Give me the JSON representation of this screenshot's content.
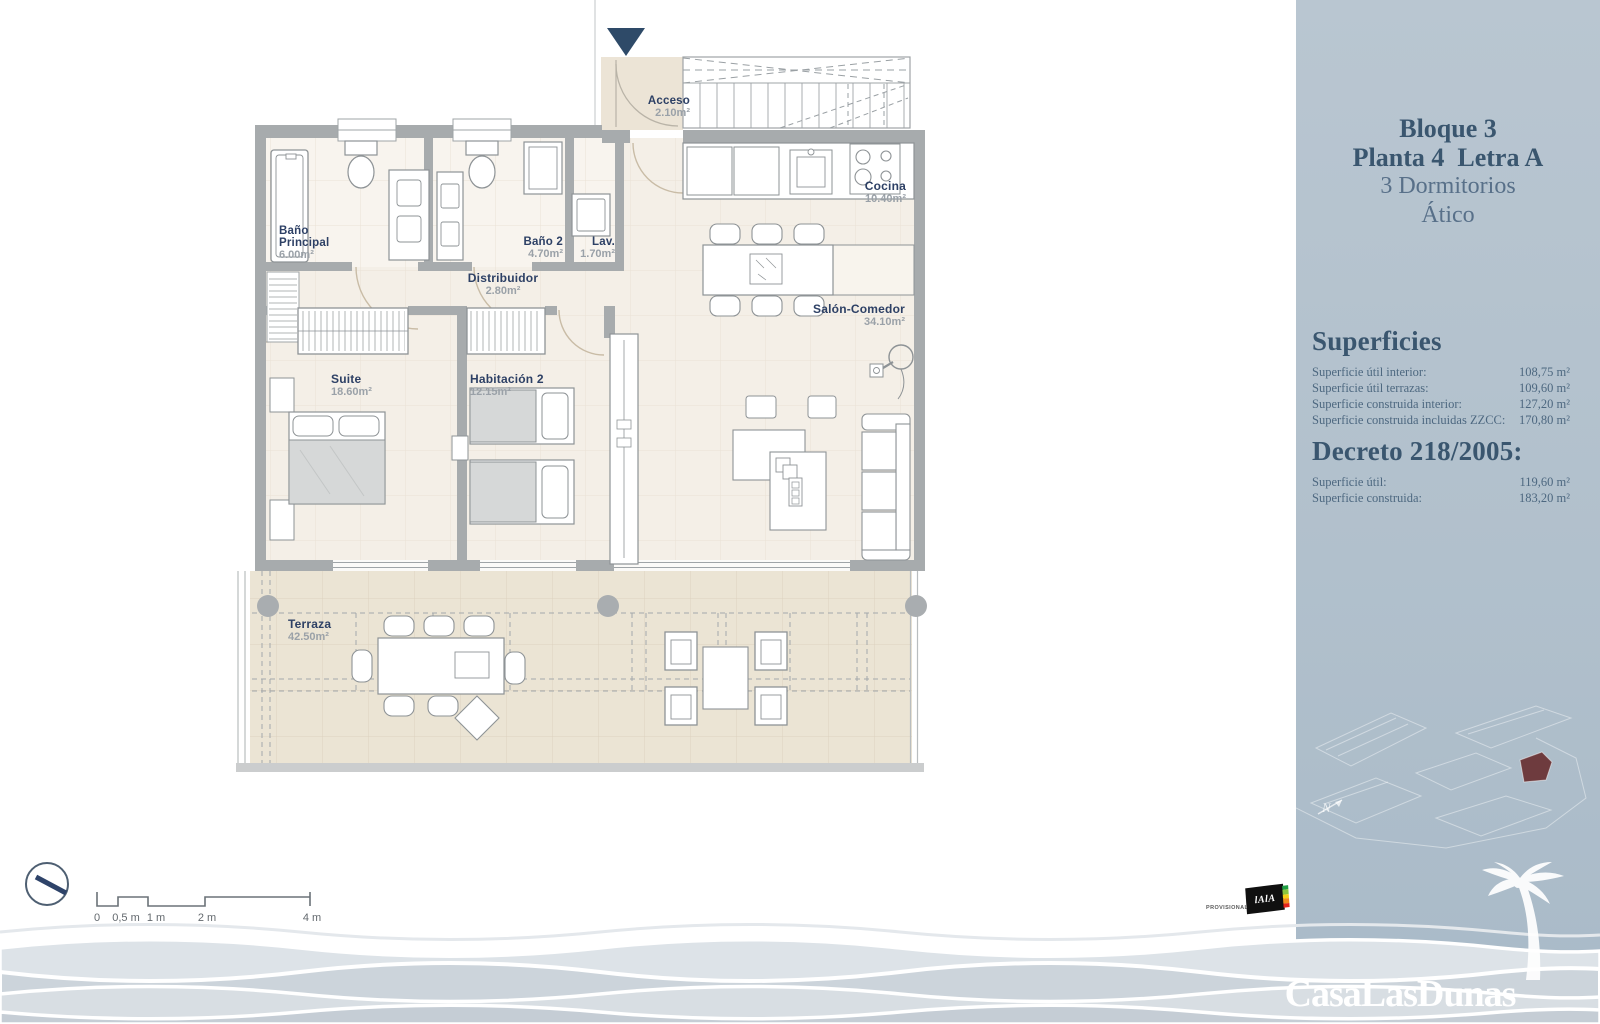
{
  "plan": {
    "rooms": {
      "acceso": {
        "name": "Acceso",
        "area": "2.10m²"
      },
      "cocina": {
        "name": "Cocina",
        "area": "10.40m²"
      },
      "bano_principal": {
        "name": "Baño Principal",
        "area": "6.00m²"
      },
      "bano2": {
        "name": "Baño 2",
        "area": "4.70m²"
      },
      "lavadero": {
        "name": "Lav.",
        "area": "1.70m²"
      },
      "distribuidor": {
        "name": "Distribuidor",
        "area": "2.80m²"
      },
      "suite": {
        "name": "Suite",
        "area": "18.60m²"
      },
      "habitacion2": {
        "name": "Habitación 2",
        "area": "12.15m²"
      },
      "salon_comedor": {
        "name": "Salón-Comedor",
        "area": "34.10m²"
      },
      "terraza": {
        "name": "Terraza",
        "area": "42.50m²"
      }
    },
    "scale_bar": {
      "labels": [
        "0",
        "0,5 m",
        "1 m",
        "2 m",
        "4 m"
      ]
    },
    "north_label": "N"
  },
  "sidebar": {
    "title": {
      "line1": "Bloque 3",
      "line2": "Planta 4  Letra A",
      "line3": "3 Dormitorios",
      "line4": "Ático"
    },
    "superficies": {
      "heading": "Superficies",
      "rows": [
        {
          "label": "Superficie útil interior:",
          "value": "108,75 m²"
        },
        {
          "label": "Superficie útil terrazas:",
          "value": "109,60 m²"
        },
        {
          "label": "Superficie construida interior:",
          "value": "127,20 m²"
        },
        {
          "label": "Superficie construida incluidas ZZCC:",
          "value": "170,80 m²"
        }
      ]
    },
    "decreto": {
      "heading": "Decreto 218/2005:",
      "rows": [
        {
          "label": "Superficie útil:",
          "value": "119,60 m²"
        },
        {
          "label": "Superficie construida:",
          "value": "183,20 m²"
        }
      ]
    }
  },
  "footer": {
    "provisional_label": "PROVISIONAL",
    "energy_logo_text": "lAlA",
    "brand": "CasaLasDunas"
  },
  "colors": {
    "sidebar_bg": "#b1c0cc",
    "heading_navy": "#3a566f",
    "room_label_navy": "#2d4065",
    "wall_gray": "#a7abad",
    "floor_beige": "#f4efe7",
    "terrace_beige": "#ebe4d4",
    "highlight_unit_red": "#6e3b3e"
  }
}
